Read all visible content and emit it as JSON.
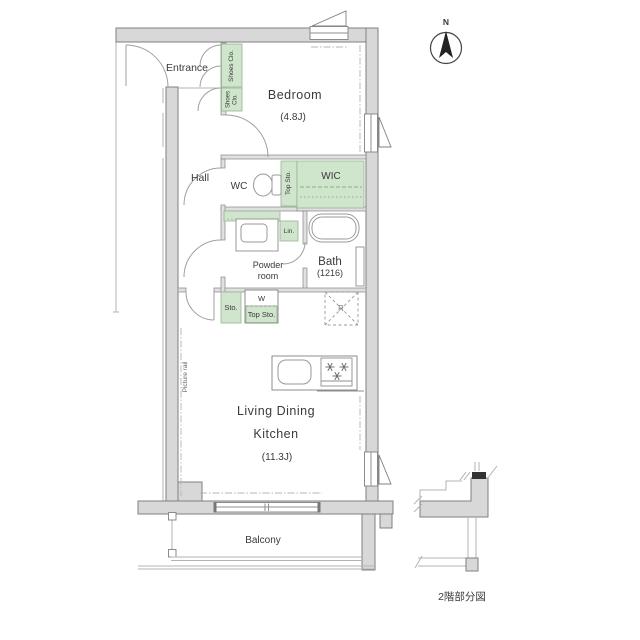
{
  "plan": {
    "compass_label": "N",
    "caption": "2階部分図",
    "rooms": {
      "entrance": "Entrance",
      "bedroom": "Bedroom",
      "bedroom_size": "(4.8J)",
      "hall": "Hall",
      "wc": "WC",
      "wic": "WIC",
      "powder_room": "Powder room",
      "bath": "Bath",
      "bath_size": "(1216)",
      "ldk_line1": "Living Dining",
      "ldk_line2": "Kitchen",
      "ldk_size": "(11.3J)",
      "balcony": "Balcony"
    },
    "storage": {
      "shoes_closet_upper": "Shoes Clo.",
      "shoes_closet_lower": "Shoes Clo.",
      "top_storage": "Top Sto.",
      "linen": "Lin.",
      "storage": "Sto.",
      "washer": "W",
      "washer_top_storage": "Top Sto.",
      "refrigerator": "R"
    },
    "notes": {
      "picture_rail": "Picture rail"
    },
    "colors": {
      "wall": "#d8d8d8",
      "storage_green": "#cfe5cc",
      "line": "#8f8f8f"
    }
  }
}
